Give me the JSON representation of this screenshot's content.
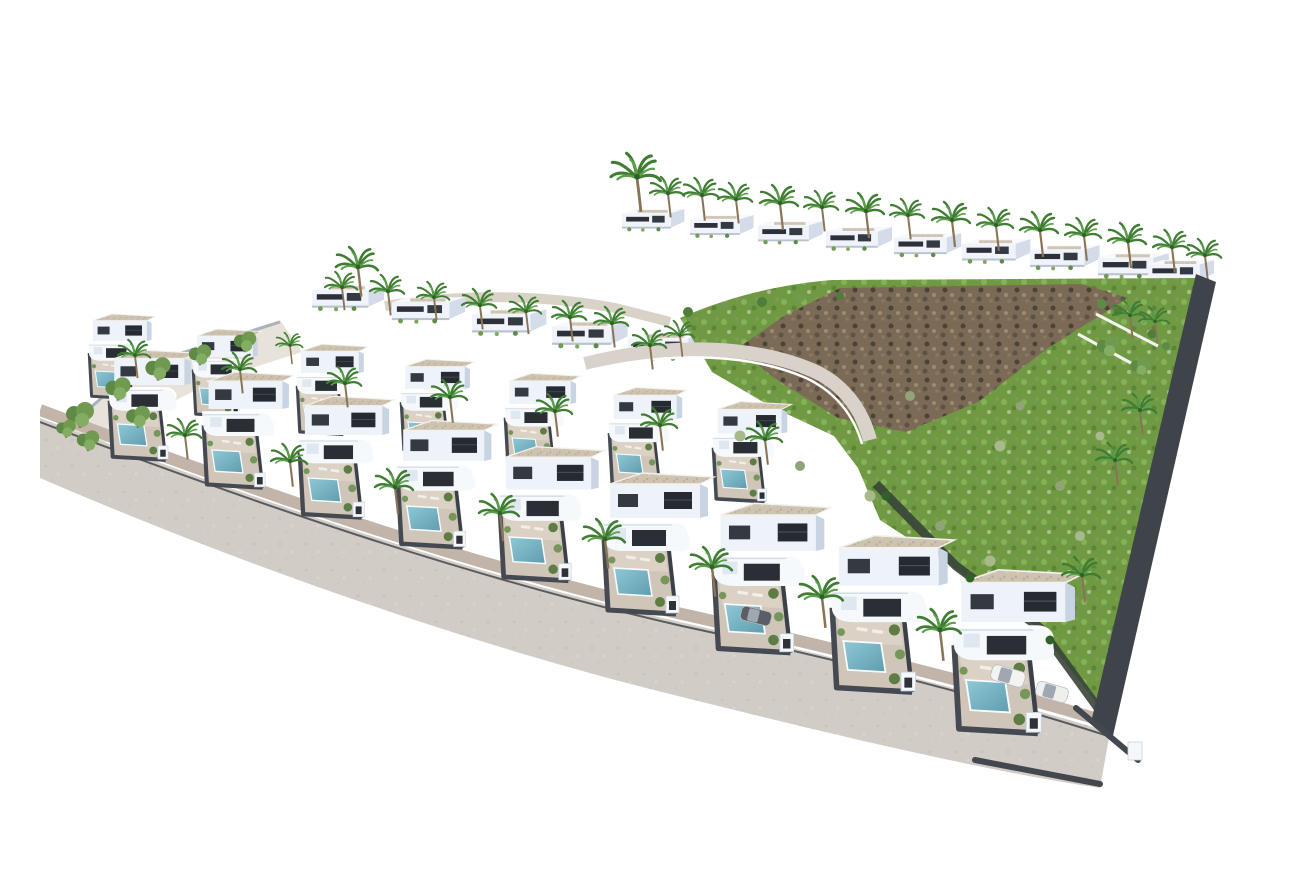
{
  "meta": {
    "title": "Aerial 3D architectural render of a white villa residential development",
    "description": "Bird's-eye render: rows of modern white villas with private pools and palm trees on a hillside, an undeveloped green and rocky plot on the right, and a curving access road in the foreground on white background",
    "visible_text": "none"
  },
  "palette": {
    "background": "#ffffff",
    "villa_face": "#eef3fa",
    "villa_shade": "#c9d4e2",
    "window_dark": "#262b31",
    "boundary_wall": "#454a52",
    "gravel_roof": "#cdc3b0",
    "pool_light": "#8fc9d6",
    "pool_dark": "#5f9cae",
    "terrace_tan": "#dbd2c5",
    "road": "#d2ccc6",
    "sidewalk": "#c3b4a9",
    "curb": "#5a5b5e",
    "grass": "#6f9a43",
    "rock": "#7b6a55",
    "palm_frond": "#3f7d33",
    "palm_trunk": "#8a7356"
  },
  "scene": {
    "paths": {
      "road": "M0,402 C200,478 420,556 640,606 C810,644 950,680 1070,716 L1060,772 C940,754 790,718 630,678 C420,626 190,544 0,462 Z",
      "sidewalk": "M0,394 C200,470 420,548 642,598 C812,636 956,672 1074,708",
      "curb": "M0,406 C200,482 422,560 642,610 C810,646 950,682 1068,720",
      "hill": "M640,302 C690,280 742,268 792,264 L1160,262 L1118,424 L1062,694 L998,612 L914,552 L840,504 L818,452 L794,420 L730,390 L672,356 Z",
      "rock": "M698,332 L744,300 L800,272 L1042,268 L1088,282 L1008,332 L938,386 L866,416 L798,402 L734,362 Z",
      "inner_road": "M545,348 C640,324 720,332 772,354 C804,368 822,394 830,424",
      "inner_road_wall": "M542,356 C638,332 716,340 766,362 C796,376 814,400 822,428",
      "upper_walkway": "M345,290 C420,278 500,278 575,292 L630,306",
      "right_wall": "M1156,258 L1176,266 L1072,724 L1052,702 Z",
      "hedge_right": "M836,468 L916,550 L1000,612 L1058,692",
      "hill_stairs": "M1056,298 L1118,330 M1038,318 L1100,352",
      "corner_walls": "M1036,692 L1098,744 M935,744 L1060,768",
      "left_terrain": "M8,430 L95,350 L240,304 L262,336 L180,362 L120,392 L60,430 L32,448 Z",
      "left_walls": "M10,428 L95,352 L240,306"
    },
    "stamps": {
      "back_row_houses": {
        "template": "tpl-back-house",
        "name": "back-row-house",
        "items": [
          {
            "x": 582,
            "y": 192,
            "s": 0.52
          },
          {
            "x": 650,
            "y": 198,
            "s": 0.53
          },
          {
            "x": 718,
            "y": 204,
            "s": 0.54
          },
          {
            "x": 786,
            "y": 210,
            "s": 0.55
          },
          {
            "x": 854,
            "y": 216,
            "s": 0.56
          },
          {
            "x": 922,
            "y": 222,
            "s": 0.57
          },
          {
            "x": 990,
            "y": 228,
            "s": 0.58
          },
          {
            "x": 1058,
            "y": 236,
            "s": 0.59
          },
          {
            "x": 1108,
            "y": 243,
            "s": 0.55
          }
        ]
      },
      "upper_row_houses": {
        "template": "tpl-back-house",
        "name": "upper-row-house",
        "items": [
          {
            "x": 272,
            "y": 268,
            "s": 0.6
          },
          {
            "x": 352,
            "y": 280,
            "s": 0.61
          },
          {
            "x": 432,
            "y": 292,
            "s": 0.62
          },
          {
            "x": 512,
            "y": 304,
            "s": 0.63
          },
          {
            "x": 588,
            "y": 316,
            "s": 0.64
          }
        ]
      },
      "mid_row_villas": {
        "template": "tpl-front-villa",
        "name": "mid-row-villa",
        "items": [
          {
            "x": 48,
            "y": 295,
            "s": 0.6
          },
          {
            "x": 152,
            "y": 310,
            "s": 0.62
          },
          {
            "x": 256,
            "y": 325,
            "s": 0.64
          },
          {
            "x": 360,
            "y": 340,
            "s": 0.66
          },
          {
            "x": 464,
            "y": 354,
            "s": 0.68
          },
          {
            "x": 568,
            "y": 368,
            "s": 0.7
          },
          {
            "x": 672,
            "y": 382,
            "s": 0.71
          }
        ]
      },
      "front_row_villas": {
        "template": "tpl-front-villa",
        "name": "front-row-villa",
        "items": [
          {
            "x": 68,
            "y": 330,
            "s": 0.78
          },
          {
            "x": 162,
            "y": 352,
            "s": 0.82
          },
          {
            "x": 258,
            "y": 376,
            "s": 0.86
          },
          {
            "x": 356,
            "y": 400,
            "s": 0.9
          },
          {
            "x": 458,
            "y": 426,
            "s": 0.95
          },
          {
            "x": 562,
            "y": 452,
            "s": 1.0
          },
          {
            "x": 672,
            "y": 482,
            "s": 1.06
          },
          {
            "x": 790,
            "y": 514,
            "s": 1.11
          },
          {
            "x": 912,
            "y": 548,
            "s": 1.16
          }
        ]
      },
      "palm_trees": {
        "template": "tpl-palm",
        "name": "palm-tree",
        "items": [
          {
            "x": 597,
            "y": 162,
            "s": 1.3
          },
          {
            "x": 628,
            "y": 178,
            "s": 0.9
          },
          {
            "x": 662,
            "y": 180,
            "s": 0.95
          },
          {
            "x": 696,
            "y": 184,
            "s": 0.9
          },
          {
            "x": 740,
            "y": 188,
            "s": 1.0
          },
          {
            "x": 782,
            "y": 192,
            "s": 0.9
          },
          {
            "x": 826,
            "y": 196,
            "s": 1.0
          },
          {
            "x": 868,
            "y": 200,
            "s": 0.9
          },
          {
            "x": 912,
            "y": 205,
            "s": 1.0
          },
          {
            "x": 956,
            "y": 210,
            "s": 0.95
          },
          {
            "x": 1000,
            "y": 215,
            "s": 1.0
          },
          {
            "x": 1044,
            "y": 220,
            "s": 0.95
          },
          {
            "x": 1088,
            "y": 226,
            "s": 1.0
          },
          {
            "x": 1132,
            "y": 232,
            "s": 0.95
          },
          {
            "x": 1165,
            "y": 240,
            "s": 0.9
          },
          {
            "x": 318,
            "y": 252,
            "s": 1.1
          },
          {
            "x": 302,
            "y": 272,
            "s": 0.85
          },
          {
            "x": 348,
            "y": 276,
            "s": 0.9
          },
          {
            "x": 394,
            "y": 282,
            "s": 0.85
          },
          {
            "x": 440,
            "y": 290,
            "s": 0.9
          },
          {
            "x": 486,
            "y": 296,
            "s": 0.85
          },
          {
            "x": 530,
            "y": 302,
            "s": 0.9
          },
          {
            "x": 572,
            "y": 308,
            "s": 0.9
          },
          {
            "x": 250,
            "y": 330,
            "s": 0.7
          },
          {
            "x": 610,
            "y": 330,
            "s": 0.9
          },
          {
            "x": 640,
            "y": 320,
            "s": 0.8
          },
          {
            "x": 95,
            "y": 340,
            "s": 0.85
          },
          {
            "x": 200,
            "y": 354,
            "s": 0.9
          },
          {
            "x": 305,
            "y": 368,
            "s": 0.9
          },
          {
            "x": 410,
            "y": 382,
            "s": 0.95
          },
          {
            "x": 515,
            "y": 396,
            "s": 0.95
          },
          {
            "x": 620,
            "y": 410,
            "s": 0.95
          },
          {
            "x": 725,
            "y": 424,
            "s": 0.95
          },
          {
            "x": 145,
            "y": 420,
            "s": 0.9
          },
          {
            "x": 250,
            "y": 446,
            "s": 0.95
          },
          {
            "x": 355,
            "y": 472,
            "s": 1.0
          },
          {
            "x": 460,
            "y": 498,
            "s": 1.05
          },
          {
            "x": 565,
            "y": 524,
            "s": 1.1
          },
          {
            "x": 672,
            "y": 552,
            "s": 1.1
          },
          {
            "x": 782,
            "y": 582,
            "s": 1.15
          },
          {
            "x": 900,
            "y": 615,
            "s": 1.15
          },
          {
            "x": 1075,
            "y": 445,
            "s": 0.95
          },
          {
            "x": 1100,
            "y": 395,
            "s": 0.9
          },
          {
            "x": 1042,
            "y": 560,
            "s": 1.0
          },
          {
            "x": 1090,
            "y": 300,
            "s": 0.85
          },
          {
            "x": 1115,
            "y": 306,
            "s": 0.8
          }
        ]
      },
      "round_trees": {
        "template": "tpl-tree",
        "name": "tree",
        "items": [
          {
            "x": 40,
            "y": 398,
            "s": 1.0
          },
          {
            "x": 78,
            "y": 372,
            "s": 0.9
          },
          {
            "x": 118,
            "y": 352,
            "s": 0.9
          },
          {
            "x": 160,
            "y": 338,
            "s": 0.8
          },
          {
            "x": 48,
            "y": 424,
            "s": 0.8
          },
          {
            "x": 26,
            "y": 412,
            "s": 0.7
          },
          {
            "x": 205,
            "y": 325,
            "s": 0.8
          },
          {
            "x": 98,
            "y": 400,
            "s": 0.85
          },
          {
            "x": 1068,
            "y": 330,
            "s": 0.8
          },
          {
            "x": 1100,
            "y": 350,
            "s": 0.7
          }
        ]
      },
      "bushes": {
        "template": "tpl-bush",
        "name": "bush",
        "items": [
          {
            "x": 648,
            "y": 296,
            "s": 1.0,
            "c": "#4f7d3a"
          },
          {
            "x": 684,
            "y": 290,
            "s": 0.9,
            "c": "#6f9a50"
          },
          {
            "x": 722,
            "y": 286,
            "s": 1.0,
            "c": "#4f7d3a"
          },
          {
            "x": 760,
            "y": 282,
            "s": 0.9,
            "c": "#6f9a50"
          },
          {
            "x": 800,
            "y": 280,
            "s": 0.8,
            "c": "#4f7d3a"
          },
          {
            "x": 1062,
            "y": 288,
            "s": 1.0,
            "c": "#5d8a46"
          },
          {
            "x": 1078,
            "y": 296,
            "s": 0.9,
            "c": "#4f7d3a"
          },
          {
            "x": 1096,
            "y": 306,
            "s": 1.0,
            "c": "#6f9a50"
          },
          {
            "x": 1112,
            "y": 318,
            "s": 0.9,
            "c": "#4f7d3a"
          },
          {
            "x": 1126,
            "y": 330,
            "s": 0.8,
            "c": "#5d8a46"
          },
          {
            "x": 700,
            "y": 420,
            "s": 1.1,
            "c": "#a8b98c"
          },
          {
            "x": 760,
            "y": 450,
            "s": 1.0,
            "c": "#8fa477"
          },
          {
            "x": 830,
            "y": 480,
            "s": 1.1,
            "c": "#a8b98c"
          },
          {
            "x": 900,
            "y": 510,
            "s": 1.0,
            "c": "#8fa477"
          },
          {
            "x": 950,
            "y": 545,
            "s": 1.1,
            "c": "#a8b98c"
          },
          {
            "x": 870,
            "y": 380,
            "s": 1.0,
            "c": "#8fa477"
          },
          {
            "x": 960,
            "y": 430,
            "s": 1.1,
            "c": "#a8b98c"
          },
          {
            "x": 1020,
            "y": 470,
            "s": 1.0,
            "c": "#8fa477"
          },
          {
            "x": 1040,
            "y": 520,
            "s": 1.0,
            "c": "#a8b98c"
          },
          {
            "x": 980,
            "y": 390,
            "s": 0.9,
            "c": "#8fa477"
          },
          {
            "x": 1060,
            "y": 420,
            "s": 0.9,
            "c": "#a8b98c"
          },
          {
            "x": 846,
            "y": 480,
            "s": 0.9,
            "c": "#2f6129"
          },
          {
            "x": 930,
            "y": 562,
            "s": 0.9,
            "c": "#2f6129"
          },
          {
            "x": 1010,
            "y": 624,
            "s": 0.9,
            "c": "#2f6129"
          }
        ]
      },
      "cars": {
        "template": "tpl-car",
        "name": "car",
        "items": [
          {
            "x": 968,
            "y": 660,
            "s": 1.0,
            "r": 16,
            "c": "#f3f4f2"
          },
          {
            "x": 1012,
            "y": 676,
            "s": 0.95,
            "r": 16,
            "c": "#eef0ee"
          },
          {
            "x": 716,
            "y": 600,
            "s": 0.9,
            "r": 14,
            "c": "#5a5f66"
          }
        ]
      }
    }
  }
}
